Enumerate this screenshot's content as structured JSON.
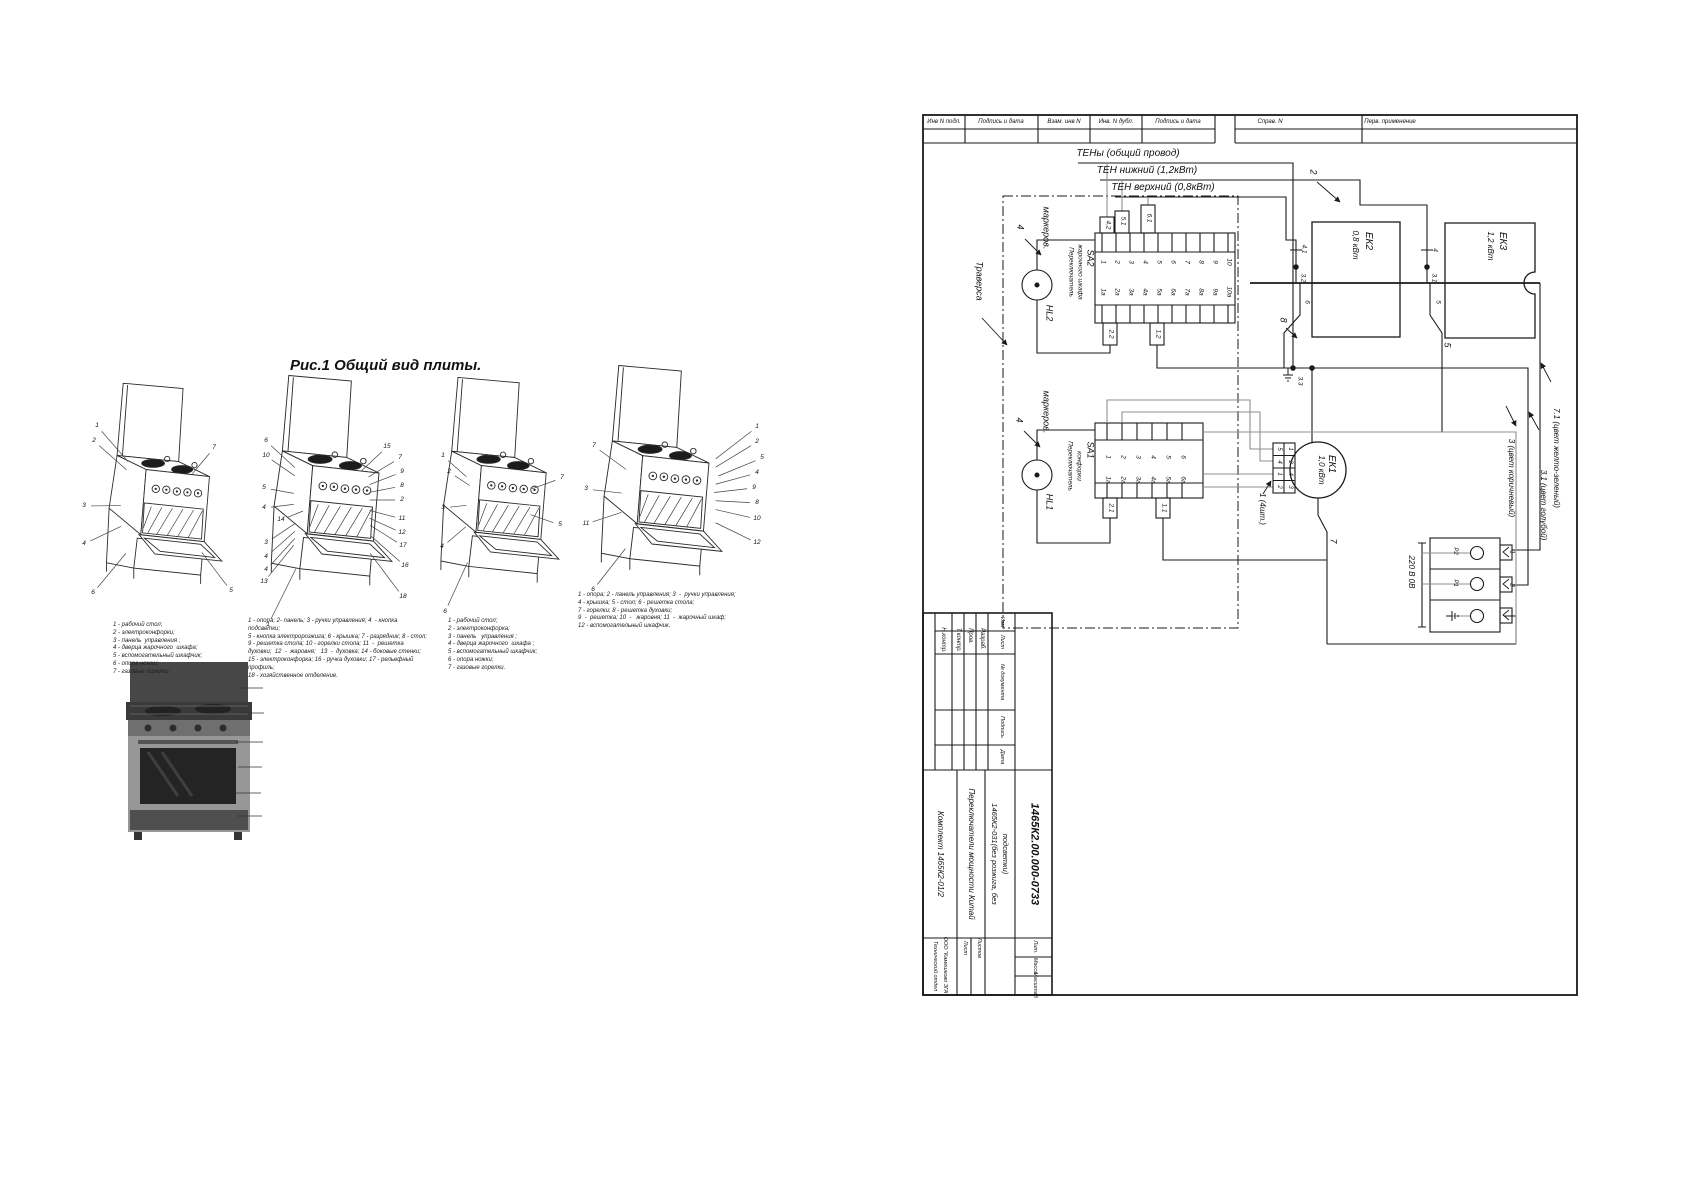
{
  "caption": "Рис.1 Общий вид плиты.",
  "colors": {
    "ink": "#1a1a1a",
    "gray": "#8f8f8f"
  },
  "header_cells": [
    {
      "t": "Инв N подл.",
      "x": 944
    },
    {
      "t": "Подпись и дата",
      "x": 1001
    },
    {
      "t": "Взам. инв N",
      "x": 1064
    },
    {
      "t": "Инв. N дубл.",
      "x": 1116
    },
    {
      "t": "Подпись и дата",
      "x": 1178
    },
    {
      "t": "Справ. N",
      "x": 1270
    },
    {
      "t": "Перв. применение",
      "x": 1390
    }
  ],
  "schematic_labels": [
    {
      "t": "ТЕНы (общий провод)",
      "x": 1128,
      "y": 154,
      "s": 10
    },
    {
      "t": "ТЕН нижний (1,2кВт)",
      "x": 1147,
      "y": 171,
      "s": 10
    },
    {
      "t": "ТЕН верхний (0,8кВт)",
      "x": 1163,
      "y": 188,
      "s": 10
    },
    {
      "t": "Траверса",
      "x": 979,
      "y": 281,
      "s": 9,
      "r": 1
    },
    {
      "t": "маркеров.",
      "x": 1046,
      "y": 228,
      "s": 9,
      "r": 1
    },
    {
      "t": "4",
      "x": 1020,
      "y": 227,
      "s": 9,
      "r": 1
    },
    {
      "t": "HL2",
      "x": 1049,
      "y": 313,
      "s": 9,
      "r": 1
    },
    {
      "t": "SA2",
      "x": 1090,
      "y": 258,
      "s": 9,
      "r": 1
    },
    {
      "t": "Переключатель",
      "x": 1070,
      "y": 272,
      "s": 6.5,
      "r": 1
    },
    {
      "t": "жарочного шкафа",
      "x": 1079,
      "y": 272,
      "s": 6.5,
      "r": 1
    },
    {
      "t": "4.2",
      "x": 1107,
      "y": 225,
      "s": 6.5,
      "r": 1
    },
    {
      "t": "5.1",
      "x": 1122,
      "y": 221,
      "s": 6.5,
      "r": 1
    },
    {
      "t": "6.1",
      "x": 1148,
      "y": 218,
      "s": 6.5,
      "r": 1
    },
    {
      "t": "1",
      "x": 1102,
      "y": 262,
      "s": 6.5,
      "r": 1
    },
    {
      "t": "2",
      "x": 1116,
      "y": 262,
      "s": 6.5,
      "r": 1
    },
    {
      "t": "3",
      "x": 1130,
      "y": 262,
      "s": 6.5,
      "r": 1
    },
    {
      "t": "4",
      "x": 1144,
      "y": 262,
      "s": 6.5,
      "r": 1
    },
    {
      "t": "5",
      "x": 1158,
      "y": 262,
      "s": 6.5,
      "r": 1
    },
    {
      "t": "6",
      "x": 1172,
      "y": 262,
      "s": 6.5,
      "r": 1
    },
    {
      "t": "7",
      "x": 1186,
      "y": 262,
      "s": 6.5,
      "r": 1
    },
    {
      "t": "8",
      "x": 1200,
      "y": 262,
      "s": 6.5,
      "r": 1
    },
    {
      "t": "9",
      "x": 1214,
      "y": 262,
      "s": 6.5,
      "r": 1
    },
    {
      "t": "10",
      "x": 1228,
      "y": 262,
      "s": 6.5,
      "r": 1
    },
    {
      "t": "1а",
      "x": 1102,
      "y": 292,
      "s": 6.5,
      "r": 1
    },
    {
      "t": "2а",
      "x": 1116,
      "y": 292,
      "s": 6.5,
      "r": 1
    },
    {
      "t": "3а",
      "x": 1130,
      "y": 292,
      "s": 6.5,
      "r": 1
    },
    {
      "t": "4а",
      "x": 1144,
      "y": 292,
      "s": 6.5,
      "r": 1
    },
    {
      "t": "5а",
      "x": 1158,
      "y": 292,
      "s": 6.5,
      "r": 1
    },
    {
      "t": "6а",
      "x": 1172,
      "y": 292,
      "s": 6.5,
      "r": 1
    },
    {
      "t": "7а",
      "x": 1186,
      "y": 292,
      "s": 6.5,
      "r": 1
    },
    {
      "t": "8а",
      "x": 1200,
      "y": 292,
      "s": 6.5,
      "r": 1
    },
    {
      "t": "9а",
      "x": 1214,
      "y": 292,
      "s": 6.5,
      "r": 1
    },
    {
      "t": "10а",
      "x": 1228,
      "y": 292,
      "s": 6.5,
      "r": 1
    },
    {
      "t": "2.2",
      "x": 1110,
      "y": 334,
      "s": 6.5,
      "r": 1
    },
    {
      "t": "1.2",
      "x": 1157,
      "y": 334,
      "s": 6.5,
      "r": 1
    },
    {
      "t": "маркеров.",
      "x": 1046,
      "y": 412,
      "s": 9,
      "r": 1
    },
    {
      "t": "4",
      "x": 1019,
      "y": 420,
      "s": 9,
      "r": 1
    },
    {
      "t": "HL1",
      "x": 1049,
      "y": 502,
      "s": 9,
      "r": 1
    },
    {
      "t": "SA1",
      "x": 1090,
      "y": 450,
      "s": 9,
      "r": 1
    },
    {
      "t": "Переключатель",
      "x": 1069,
      "y": 466,
      "s": 6.5,
      "r": 1
    },
    {
      "t": "конфорки",
      "x": 1078,
      "y": 466,
      "s": 6.5,
      "r": 1
    },
    {
      "t": "1",
      "x": 1107,
      "y": 457,
      "s": 6.5,
      "r": 1
    },
    {
      "t": "2",
      "x": 1122,
      "y": 457,
      "s": 6.5,
      "r": 1
    },
    {
      "t": "3",
      "x": 1137,
      "y": 457,
      "s": 6.5,
      "r": 1
    },
    {
      "t": "4",
      "x": 1152,
      "y": 457,
      "s": 6.5,
      "r": 1
    },
    {
      "t": "5",
      "x": 1167,
      "y": 457,
      "s": 6.5,
      "r": 1
    },
    {
      "t": "6",
      "x": 1182,
      "y": 457,
      "s": 6.5,
      "r": 1
    },
    {
      "t": "1а",
      "x": 1107,
      "y": 480,
      "s": 6.5,
      "r": 1
    },
    {
      "t": "2а",
      "x": 1122,
      "y": 480,
      "s": 6.5,
      "r": 1
    },
    {
      "t": "3а",
      "x": 1137,
      "y": 480,
      "s": 6.5,
      "r": 1
    },
    {
      "t": "4а",
      "x": 1152,
      "y": 480,
      "s": 6.5,
      "r": 1
    },
    {
      "t": "5а",
      "x": 1167,
      "y": 480,
      "s": 6.5,
      "r": 1
    },
    {
      "t": "6а",
      "x": 1182,
      "y": 480,
      "s": 6.5,
      "r": 1
    },
    {
      "t": "2.1",
      "x": 1110,
      "y": 508,
      "s": 6.5,
      "r": 1
    },
    {
      "t": "1.1",
      "x": 1163,
      "y": 508,
      "s": 6.5,
      "r": 1
    },
    {
      "t": "ЕК2",
      "x": 1368,
      "y": 241,
      "s": 10,
      "r": 1
    },
    {
      "t": "0,8 кВт",
      "x": 1355,
      "y": 245,
      "s": 8,
      "r": 1
    },
    {
      "t": "ЕК3",
      "x": 1502,
      "y": 241,
      "s": 10,
      "r": 1
    },
    {
      "t": "1,2 кВт",
      "x": 1490,
      "y": 246,
      "s": 8,
      "r": 1
    },
    {
      "t": "ЕК1",
      "x": 1331,
      "y": 464,
      "s": 10,
      "r": 1
    },
    {
      "t": "1,0 кВт",
      "x": 1321,
      "y": 470,
      "s": 8,
      "r": 1
    },
    {
      "t": "2",
      "x": 1313,
      "y": 172,
      "s": 9,
      "r": 1
    },
    {
      "t": "8",
      "x": 1283,
      "y": 320,
      "s": 9,
      "r": 1
    },
    {
      "t": "4.1",
      "x": 1303,
      "y": 249,
      "s": 6.5,
      "r": 1
    },
    {
      "t": "3.2",
      "x": 1302,
      "y": 278,
      "s": 6.5,
      "r": 1
    },
    {
      "t": "6",
      "x": 1306,
      "y": 302,
      "s": 6.5,
      "r": 1
    },
    {
      "t": "4",
      "x": 1434,
      "y": 250,
      "s": 6.5,
      "r": 1
    },
    {
      "t": "3.1",
      "x": 1433,
      "y": 278,
      "s": 6.5,
      "r": 1
    },
    {
      "t": "5",
      "x": 1437,
      "y": 302,
      "s": 6.5,
      "r": 1
    },
    {
      "t": "5",
      "x": 1447,
      "y": 345,
      "s": 9,
      "r": 1
    },
    {
      "t": "3.3",
      "x": 1299,
      "y": 381,
      "s": 6.5,
      "r": 1
    },
    {
      "t": "7",
      "x": 1333,
      "y": 541,
      "s": 9,
      "r": 1
    },
    {
      "t": "1 (4шт.)",
      "x": 1262,
      "y": 509,
      "s": 8,
      "r": 1
    },
    {
      "t": "5",
      "x": 1279,
      "y": 449,
      "s": 6,
      "r": 1
    },
    {
      "t": "4",
      "x": 1279,
      "y": 462,
      "s": 6,
      "r": 1
    },
    {
      "t": "1",
      "x": 1279,
      "y": 474,
      "s": 6,
      "r": 1
    },
    {
      "t": "2",
      "x": 1279,
      "y": 487,
      "s": 6,
      "r": 1
    },
    {
      "t": "1",
      "x": 1290,
      "y": 449,
      "s": 6,
      "r": 1
    },
    {
      "t": "2",
      "x": 1290,
      "y": 462,
      "s": 6,
      "r": 1
    },
    {
      "t": "4",
      "x": 1290,
      "y": 474,
      "s": 6,
      "r": 1
    },
    {
      "t": "3",
      "x": 1290,
      "y": 487,
      "s": 6,
      "r": 1
    },
    {
      "t": "7.1 (цвет желто-зеленый)",
      "x": 1556,
      "y": 458,
      "s": 8,
      "r": 1
    },
    {
      "t": "3.1 (цвет голубой)",
      "x": 1543,
      "y": 505,
      "s": 8,
      "r": 1
    },
    {
      "t": "3 (цвет коричневый)",
      "x": 1511,
      "y": 478,
      "s": 8,
      "r": 1
    },
    {
      "t": "220 В  0В",
      "x": 1411,
      "y": 572,
      "s": 8,
      "r": 1
    },
    {
      "t": "Р2",
      "x": 1455,
      "y": 551,
      "s": 6,
      "r": 1
    },
    {
      "t": "Р1",
      "x": 1455,
      "y": 583,
      "s": 6,
      "r": 1
    },
    {
      "t": "1",
      "x": 1511,
      "y": 552,
      "s": 6.5,
      "r": 1
    },
    {
      "t": "2",
      "x": 1511,
      "y": 585,
      "s": 6.5,
      "r": 1
    }
  ],
  "title_block_labels": [
    {
      "t": "Н.контр.",
      "x": 943,
      "y": 640,
      "s": 6,
      "r": 1
    },
    {
      "t": "Т.контр.",
      "x": 958,
      "y": 640,
      "s": 6,
      "r": 1
    },
    {
      "t": "Пров.",
      "x": 970,
      "y": 636,
      "s": 6,
      "r": 1
    },
    {
      "t": "Разраб.",
      "x": 982,
      "y": 639,
      "s": 6,
      "r": 1
    },
    {
      "t": "Изм",
      "x": 1001,
      "y": 622,
      "s": 5.5,
      "r": 1
    },
    {
      "t": "Лист",
      "x": 1001,
      "y": 642,
      "s": 5.5,
      "r": 1
    },
    {
      "t": "№ документа",
      "x": 1001,
      "y": 682,
      "s": 5.5,
      "r": 1
    },
    {
      "t": "Подпись",
      "x": 1001,
      "y": 727,
      "s": 5.5,
      "r": 1
    },
    {
      "t": "Дата",
      "x": 1001,
      "y": 757,
      "s": 5.5,
      "r": 1
    },
    {
      "t": "Комплект 1465К2-01/2",
      "x": 940,
      "y": 854,
      "s": 8,
      "r": 1
    },
    {
      "t": "Переключатели мощности Китай",
      "x": 971,
      "y": 854,
      "s": 8,
      "r": 1
    },
    {
      "t": "1465К2-031(без розжига, без",
      "x": 994,
      "y": 854,
      "s": 7.5,
      "r": 1
    },
    {
      "t": "подсветки)",
      "x": 1005,
      "y": 854,
      "s": 7.5,
      "r": 1
    },
    {
      "t": "1465К2.00.000-0733",
      "x": 1034,
      "y": 854,
      "s": 11,
      "b": 1,
      "r": 1
    },
    {
      "t": "Лист",
      "x": 964,
      "y": 948,
      "s": 5.5,
      "r": 1
    },
    {
      "t": "Листов",
      "x": 978,
      "y": 948,
      "s": 5.5,
      "r": 1
    },
    {
      "t": "Лит.",
      "x": 1034,
      "y": 947,
      "s": 5.5,
      "r": 1
    },
    {
      "t": "Масса",
      "x": 1034,
      "y": 966,
      "s": 5.5,
      "r": 1
    },
    {
      "t": "Масштаб",
      "x": 1034,
      "y": 985,
      "s": 5.5,
      "r": 1
    },
    {
      "t": "Технический отдел",
      "x": 934,
      "y": 966,
      "s": 5.5,
      "r": 1
    },
    {
      "t": "ООО \"Камешково ЗГА\"",
      "x": 944,
      "y": 966,
      "s": 5.5,
      "r": 1
    }
  ],
  "figures": [
    {
      "cx": 166,
      "cy": 505,
      "callouts": [
        [
          "1",
          97,
          426
        ],
        [
          "2",
          94,
          441
        ],
        [
          "7",
          214,
          448
        ],
        [
          "3",
          84,
          506
        ],
        [
          "4",
          84,
          544
        ],
        [
          "5",
          231,
          591
        ],
        [
          "6",
          93,
          593
        ]
      ],
      "legend": {
        "x": 113,
        "y": 622,
        "lines": [
          "1 - рабочий стол;",
          "2 - электроконфорки;",
          "3 - панель  управления ;",
          "4 - дверца жарочного  шкафа;",
          "5 - вспомогательный шкафчик;",
          "6 - опора ножки;",
          "7 - газовые горелки."
        ]
      }
    },
    {
      "cx": 330,
      "cy": 500,
      "callouts": [
        [
          "6",
          266,
          441
        ],
        [
          "10",
          266,
          456
        ],
        [
          "15",
          387,
          447
        ],
        [
          "7",
          400,
          458
        ],
        [
          "9",
          402,
          472
        ],
        [
          "8",
          402,
          486
        ],
        [
          "2",
          402,
          500
        ],
        [
          "5",
          264,
          488
        ],
        [
          "4",
          264,
          508
        ],
        [
          "14",
          281,
          520
        ],
        [
          "3",
          266,
          543
        ],
        [
          "4",
          266,
          557
        ],
        [
          "4",
          266,
          570
        ],
        [
          "13",
          264,
          582
        ],
        [
          "11",
          402,
          519
        ],
        [
          "12",
          402,
          533
        ],
        [
          "17",
          403,
          546
        ],
        [
          "16",
          405,
          566
        ],
        [
          "18",
          403,
          597
        ],
        [
          "1",
          268,
          625
        ]
      ],
      "legend": {
        "x": 248,
        "y": 618,
        "lines": [
          "1 - опора; 2- панель; 3 - ручки управления; 4  - кнопка",
          "подсветки;",
          "5 - кнопка электророзжига; 6 - крышка; 7 - разрядник; 8 - стол;",
          "9 - решетка стола; 10 - горелки стола; 11  -  решетка",
          "духовки;  12  -  жаровня;   13  -  духовка; 14 - боковые стенки;",
          "15 - электроконфорка; 16 - ручка духовки; 17 - рельефный",
          "профиль;",
          "18 - хозяйственное отделение."
        ]
      }
    },
    {
      "cx": 495,
      "cy": 502,
      "callouts": [
        [
          "1",
          443,
          456
        ],
        [
          "2",
          449,
          472
        ],
        [
          "3",
          443,
          508
        ],
        [
          "4",
          442,
          547
        ],
        [
          "6",
          445,
          612
        ],
        [
          "5",
          560,
          525
        ],
        [
          "7",
          562,
          478
        ]
      ],
      "legend": {
        "x": 448,
        "y": 618,
        "lines": [
          "1 - рабочий стол;",
          "2 - электроконфорка;",
          "3 - панель   управления ;",
          "4 - дверца жарочного  шкафа ;",
          "5 - вспомогательный шкафчик;",
          "6 - опора ножки;",
          "7 - газовые горелки."
        ]
      }
    },
    {
      "cx": 665,
      "cy": 498,
      "callouts": [
        [
          "7",
          594,
          446
        ],
        [
          "1",
          757,
          427
        ],
        [
          "2",
          757,
          442
        ],
        [
          "5",
          762,
          458
        ],
        [
          "4",
          757,
          473
        ],
        [
          "9",
          754,
          488
        ],
        [
          "8",
          757,
          503
        ],
        [
          "10",
          757,
          519
        ],
        [
          "3",
          586,
          489
        ],
        [
          "11",
          586,
          524
        ],
        [
          "12",
          757,
          543
        ],
        [
          "6",
          593,
          590
        ]
      ],
      "legend": {
        "x": 578,
        "y": 592,
        "lines": [
          "1 - опора; 2 - панель управления; 3  -  ручки управления;",
          "4 - крышка; 5 - стол; 6 - решетка стола;",
          "7 - горелки; 8 - решетка духовки;",
          "9  -  решетка; 10  -   жаровня; 11  -  жарочный шкаф;",
          "12 - вспомогательный шкафчик."
        ]
      }
    }
  ]
}
